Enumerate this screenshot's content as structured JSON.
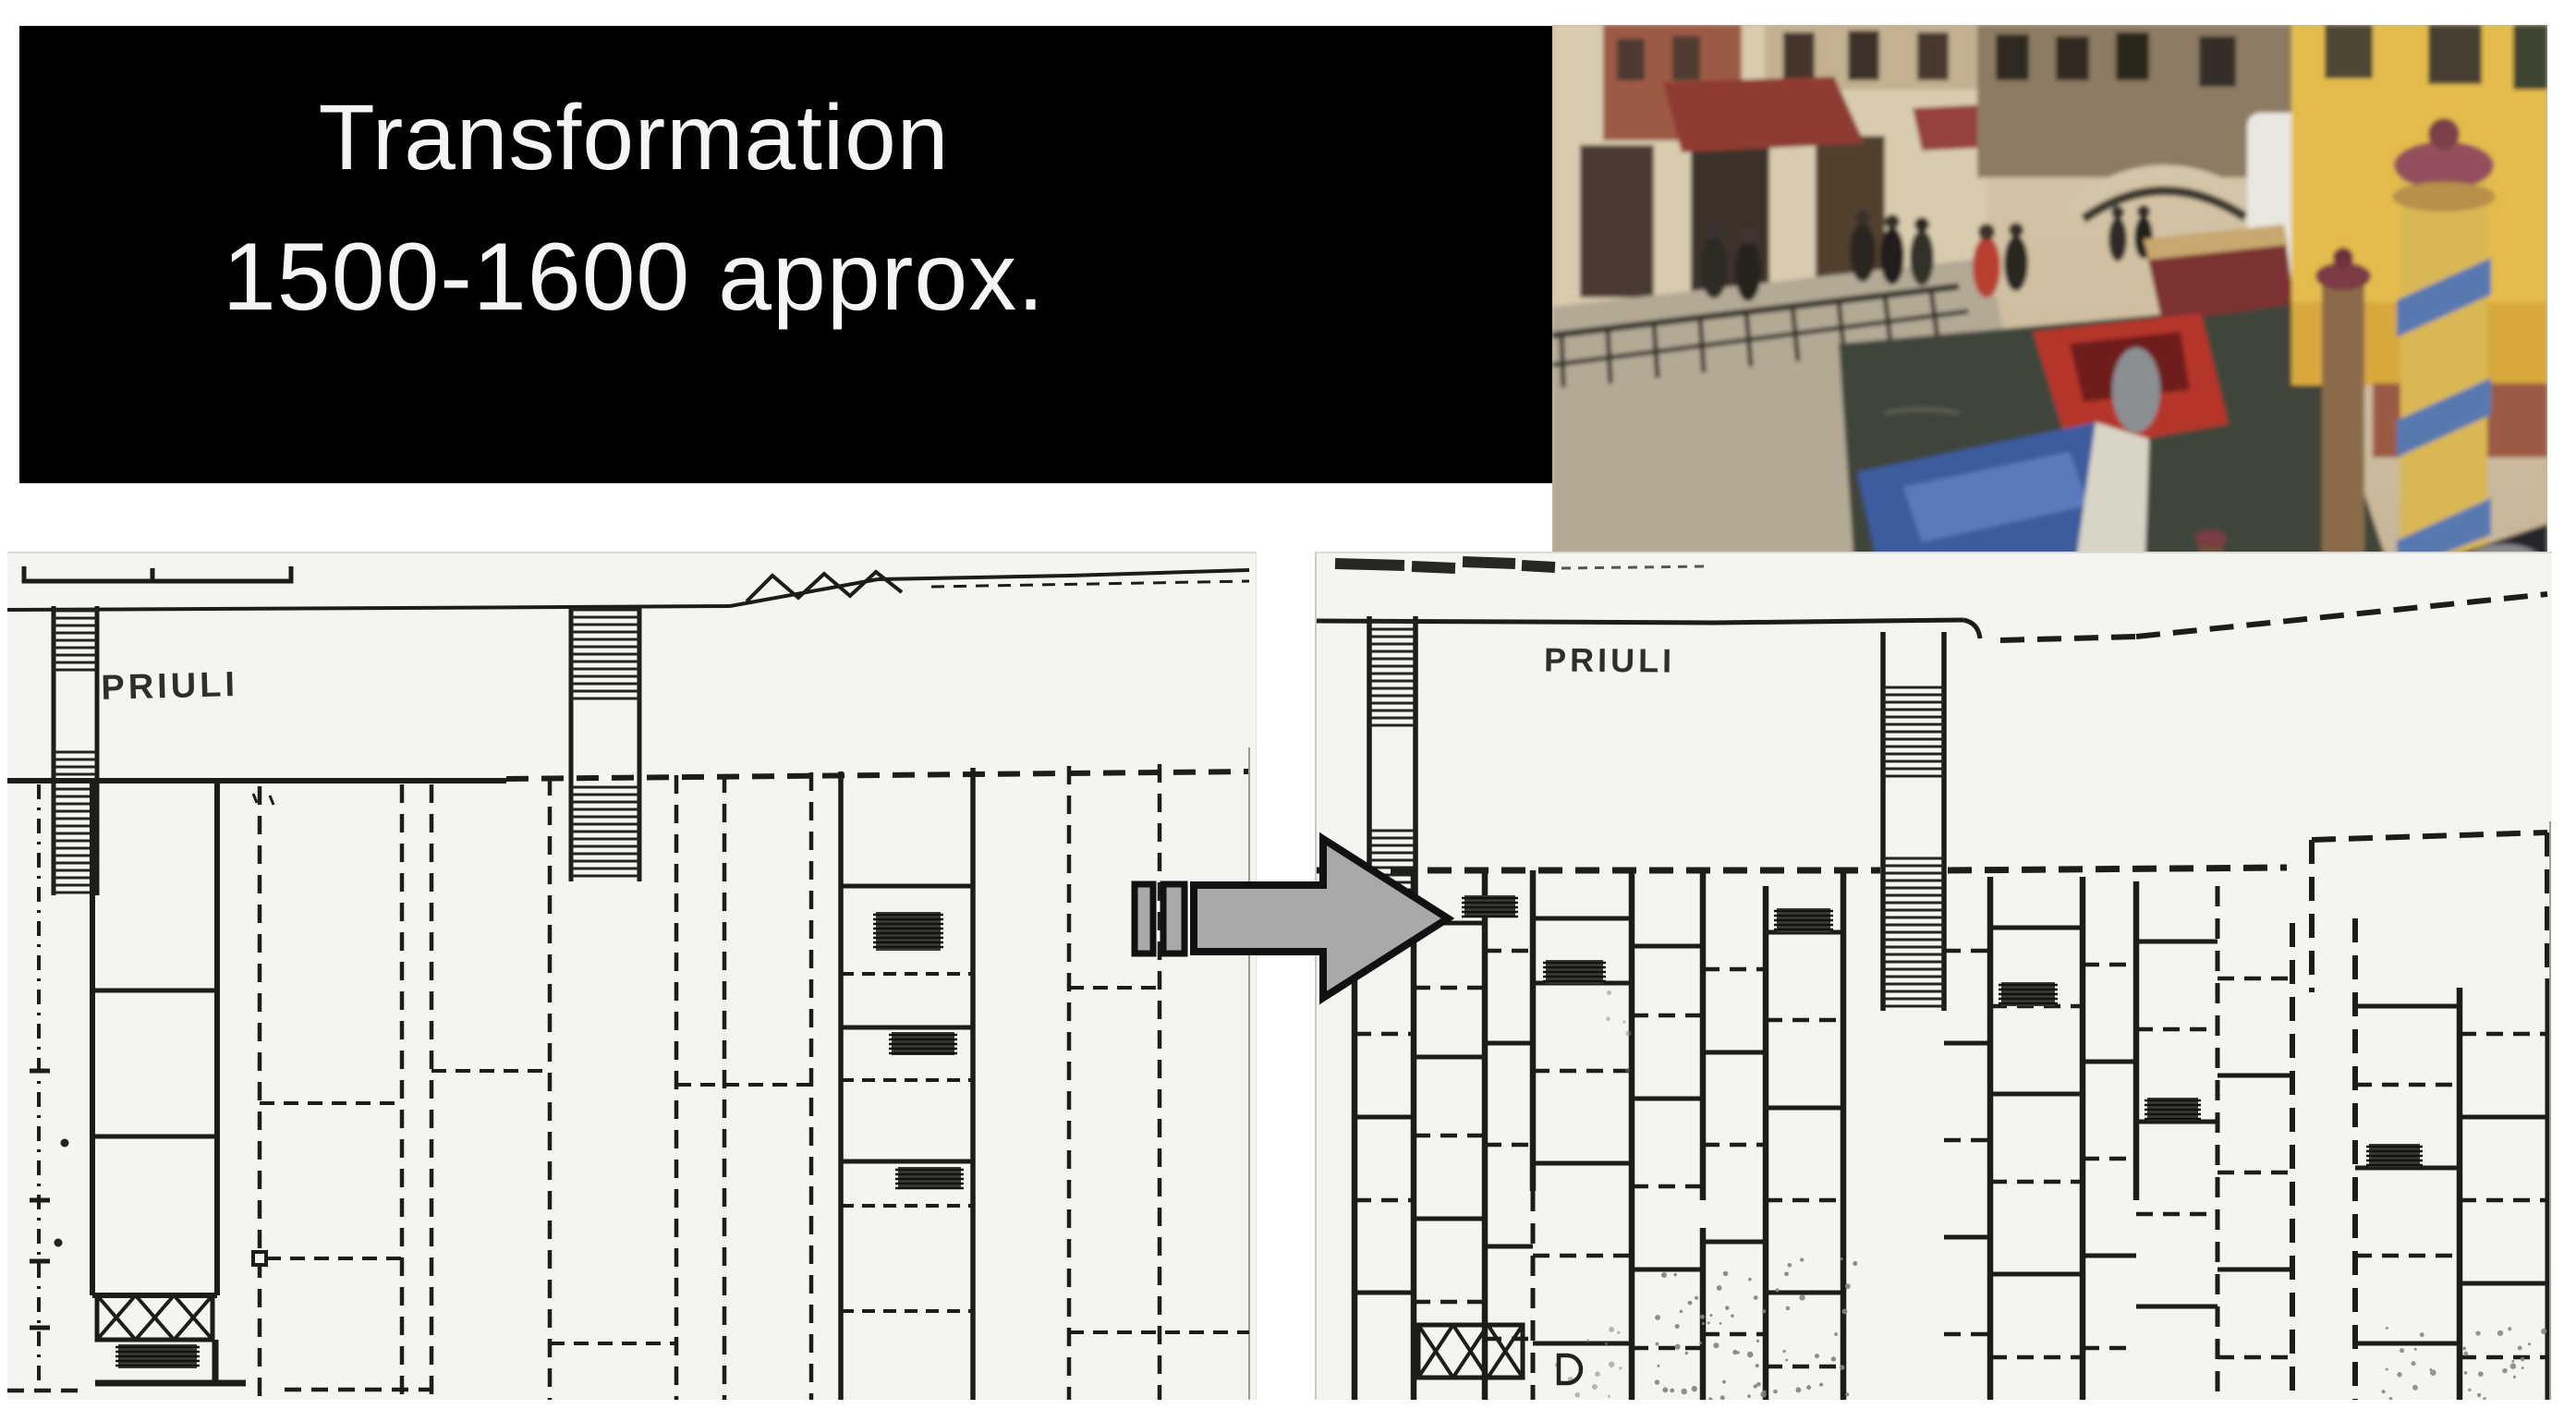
{
  "slide": {
    "title": {
      "line1": "Transformation",
      "line2": "1500-1600 approx."
    },
    "background_color": "#ffffff"
  },
  "banner": {
    "background_color": "#000000",
    "text_color": "#f5f5f3"
  },
  "photo": {
    "description": "Venice canal scene: shop-lined promenade with railing and pedestrians, red awning, stone bridge, moored boats with blue tarp and red hulls, yellow palazzo and large blue-striped mooring poles",
    "position": "top-right"
  },
  "maps": {
    "left": {
      "label": "PRIULI",
      "role": "before state, ca. 1500"
    },
    "right": {
      "label": "PRIULI",
      "role": "after state, ca. 1600"
    },
    "ink_color": "#1c1c1a",
    "paper_color": "#f4f4f1"
  },
  "arrow": {
    "direction": "right",
    "fill_color": "#a9a9a9",
    "outline_color": "#111111"
  }
}
